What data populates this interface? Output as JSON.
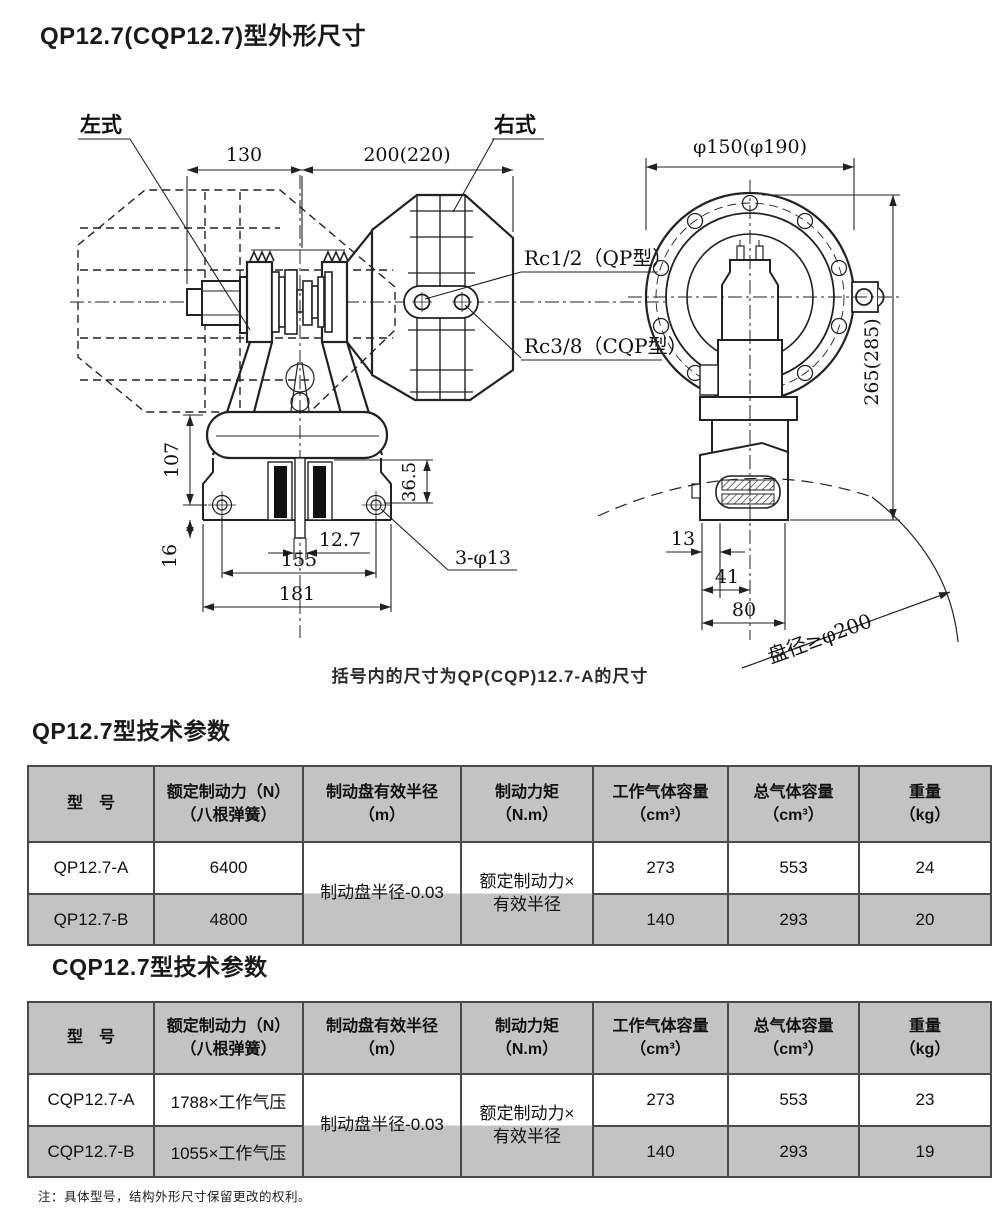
{
  "page": {
    "title": "QP12.7(CQP12.7)型外形尺寸",
    "note": "注：具体型号，结构外形尺寸保留更改的权利。"
  },
  "drawing": {
    "caption": "括号内的尺寸为QP(CQP)12.7-A的尺寸",
    "labels": {
      "left_type": "左式",
      "right_type": "右式",
      "rc_qp": "Rc1/2（QP型）",
      "rc_cqp": "Rc3/8（CQP型）",
      "disc_dia": "盘径≥φ200"
    },
    "dims": {
      "front_left": "130",
      "front_right": "200(220)",
      "flange_dia": "φ150(φ190)",
      "overall_height": "265(285)",
      "height_107": "107",
      "height_16": "16",
      "pad_height": "36.5",
      "disc_thickness": "12.7",
      "hole_span": "155",
      "base_width": "181",
      "mount_holes": "3-φ13",
      "side_13": "13",
      "side_41": "41",
      "side_80": "80"
    }
  },
  "table_qp": {
    "title": "QP12.7型技术参数",
    "headers": [
      {
        "line1": "型　号",
        "line2": ""
      },
      {
        "line1": "额定制动力（N）",
        "line2": "（八根弹簧）"
      },
      {
        "line1": "制动盘有效半径",
        "line2": "（m）"
      },
      {
        "line1": "制动力矩",
        "line2": "（N.m）"
      },
      {
        "line1": "工作气体容量",
        "line2": "（cm³）"
      },
      {
        "line1": "总气体容量",
        "line2": "（cm³）"
      },
      {
        "line1": "重量",
        "line2": "（kg）"
      }
    ],
    "merged": {
      "radius": "制动盘半径-0.03",
      "torque_line1": "额定制动力×",
      "torque_line2": "有效半径"
    },
    "rows": [
      {
        "model": "QP12.7-A",
        "force": "6400",
        "work_vol": "273",
        "total_vol": "553",
        "weight": "24"
      },
      {
        "model": "QP12.7-B",
        "force": "4800",
        "work_vol": "140",
        "total_vol": "293",
        "weight": "20"
      }
    ]
  },
  "table_cqp": {
    "title": "CQP12.7型技术参数",
    "headers": [
      {
        "line1": "型　号",
        "line2": ""
      },
      {
        "line1": "额定制动力（N）",
        "line2": "（八根弹簧）"
      },
      {
        "line1": "制动盘有效半径",
        "line2": "（m）"
      },
      {
        "line1": "制动力矩",
        "line2": "（N.m）"
      },
      {
        "line1": "工作气体容量",
        "line2": "（cm³）"
      },
      {
        "line1": "总气体容量",
        "line2": "（cm³）"
      },
      {
        "line1": "重量",
        "line2": "（kg）"
      }
    ],
    "merged": {
      "radius": "制动盘半径-0.03",
      "torque_line1": "额定制动力×",
      "torque_line2": "有效半径"
    },
    "rows": [
      {
        "model": "CQP12.7-A",
        "force": "1788×工作气压",
        "work_vol": "273",
        "total_vol": "553",
        "weight": "23"
      },
      {
        "model": "CQP12.7-B",
        "force": "1055×工作气压",
        "work_vol": "140",
        "total_vol": "293",
        "weight": "19"
      }
    ]
  },
  "colors": {
    "table_header_bg": "#c3c3c3",
    "table_border": "#4a4a4a",
    "line": "#222222"
  }
}
